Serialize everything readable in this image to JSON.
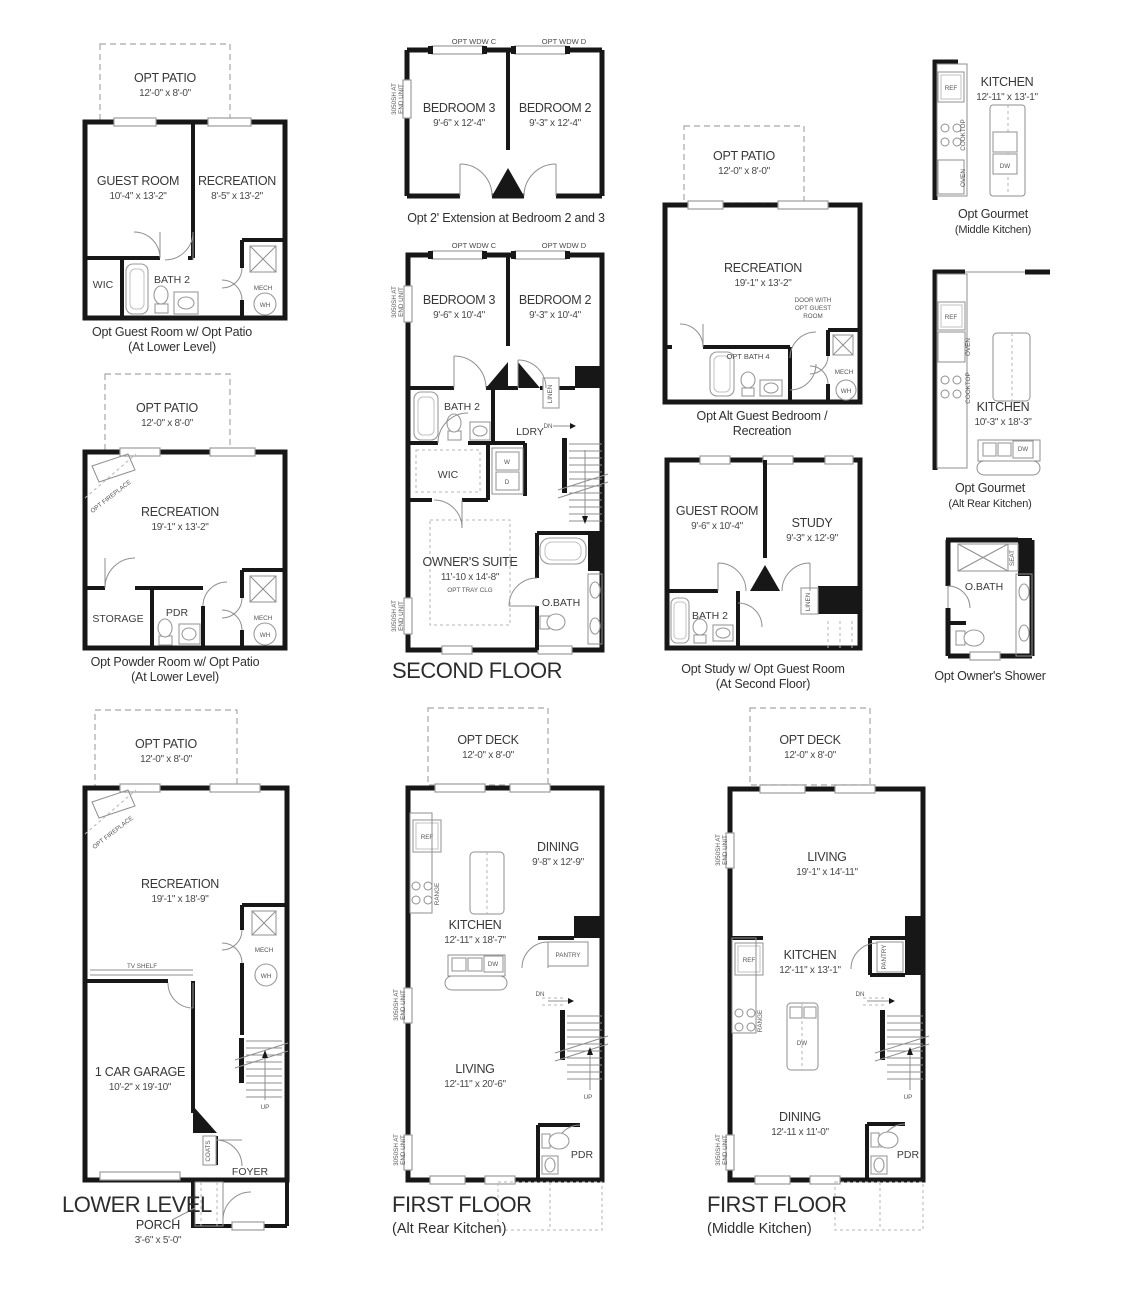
{
  "p1": {
    "patio": "OPT PATIO",
    "patio_dims": "12'-0\" x 8'-0\"",
    "guest": "GUEST ROOM",
    "guest_dims": "10'-4\" x 13'-2\"",
    "rec": "RECREATION",
    "rec_dims": "8'-5\" x 13'-2\"",
    "wic": "WIC",
    "bath": "BATH 2",
    "mech": "MECH",
    "wh": "WH",
    "cap1": "Opt Guest Room w/ Opt Patio",
    "cap2": "(At Lower Level)"
  },
  "p2": {
    "patio": "OPT PATIO",
    "patio_dims": "12'-0\" x 8'-0\"",
    "fireplace": "OPT FIREPLACE",
    "rec": "RECREATION",
    "rec_dims": "19'-1\" x 13'-2\"",
    "storage": "STORAGE",
    "pdr": "PDR",
    "mech": "MECH",
    "wh": "WH",
    "cap1": "Opt Powder Room w/ Opt Patio",
    "cap2": "(At Lower Level)"
  },
  "p3": {
    "patio": "OPT PATIO",
    "patio_dims": "12'-0\" x 8'-0\"",
    "fireplace": "OPT FIREPLACE",
    "rec": "RECREATION",
    "rec_dims": "19'-1\" x 18'-9\"",
    "mech": "MECH",
    "wh": "WH",
    "tv": "TV SHELF",
    "garage": "1 CAR GARAGE",
    "garage_dims": "10'-2\" x 19'-10\"",
    "coats": "COATS",
    "foyer": "FOYER",
    "up": "UP",
    "title": "LOWER LEVEL",
    "porch": "PORCH",
    "porch_dims": "3'-6\" x 5'-0\""
  },
  "p4": {
    "wdw_c": "OPT WDW C",
    "wdw_d": "OPT WDW D",
    "sh1": "3050SH AT",
    "sh2": "END UNIT",
    "b3": "BEDROOM 3",
    "b3_dims": "9'-6\" x 12'-4\"",
    "b2": "BEDROOM 2",
    "b2_dims": "9'-3\" x 12'-4\"",
    "cap": "Opt 2' Extension at Bedroom 2 and 3"
  },
  "p5": {
    "wdw_c": "OPT WDW C",
    "wdw_d": "OPT WDW D",
    "sh1": "3050SH AT",
    "sh2": "END UNIT",
    "b3": "BEDROOM 3",
    "b3_dims": "9'-6\" x 10'-4\"",
    "b2": "BEDROOM 2",
    "b2_dims": "9'-3\" x 10'-4\"",
    "bath": "BATH 2",
    "linen": "LINEN",
    "ldry": "LDRY",
    "dn": "DN",
    "w": "W",
    "d": "D",
    "wic": "WIC",
    "owners": "OWNER'S SUITE",
    "owners_dims": "11'-10 x 14'-8\"",
    "owners_note": "OPT TRAY CLG",
    "obath": "O.BATH",
    "title": "SECOND FLOOR"
  },
  "p6": {
    "patio": "OPT PATIO",
    "patio_dims": "12'-0\" x 8'-0\"",
    "rec": "RECREATION",
    "rec_dims": "19'-1\" x 13'-2\"",
    "door1": "DOOR WITH",
    "door2": "OPT GUEST",
    "door3": "ROOM",
    "bath4": "OPT BATH 4",
    "mech": "MECH",
    "wh": "WH",
    "cap1": "Opt Alt Guest Bedroom /",
    "cap2": "Recreation"
  },
  "p7": {
    "guest": "GUEST ROOM",
    "guest_dims": "9'-6\" x 10'-4\"",
    "study": "STUDY",
    "study_dims": "9'-3\" x 12'-9\"",
    "bath": "BATH 2",
    "linen": "LINEN",
    "cap1": "Opt Study w/ Opt Guest Room",
    "cap2": "(At Second Floor)"
  },
  "p8": {
    "ref": "REF",
    "kitchen": "KITCHEN",
    "kitchen_dims": "12'-11\" x 13'-1\"",
    "cooktop": "COOKTOP",
    "oven": "OVEN",
    "dw": "DW",
    "cap1": "Opt Gourmet",
    "cap2": "(Middle Kitchen)"
  },
  "p9": {
    "ref": "REF",
    "oven": "OVEN",
    "cooktop": "COOKTOP",
    "kitchen": "KITCHEN",
    "kitchen_dims": "10'-3\" x 18'-3\"",
    "dw": "DW",
    "cap1": "Opt Gourmet",
    "cap2": "(Alt Rear Kitchen)"
  },
  "p10": {
    "seat": "SEAT",
    "obath": "O.BATH",
    "cap": "Opt Owner's Shower"
  },
  "p11": {
    "deck": "OPT DECK",
    "deck_dims": "12'-0\" x 8'-0\"",
    "ref": "REF",
    "range": "RANGE",
    "dining": "DINING",
    "dining_dims": "9'-8\" x 12'-9\"",
    "kitchen": "KITCHEN",
    "kitchen_dims": "12'-11\" x 18'-7\"",
    "dw": "DW",
    "pantry": "PANTRY",
    "dn": "DN",
    "living": "LIVING",
    "living_dims": "12'-11\" x 20'-6\"",
    "up": "UP",
    "pdr": "PDR",
    "sh1": "3050SH AT",
    "sh2": "END UNIT",
    "title": "FIRST FLOOR",
    "subtitle": "(Alt Rear Kitchen)"
  },
  "p12": {
    "deck": "OPT DECK",
    "deck_dims": "12'-0\" x 8'-0\"",
    "sh1": "3050SH AT",
    "sh2": "END UNIT",
    "living": "LIVING",
    "living_dims": "19'-1\" x 14'-11\"",
    "kitchen": "KITCHEN",
    "kitchen_dims": "12'-11\" x 13'-1\"",
    "ref": "REF",
    "pantry": "PANTRY",
    "range": "RANGE",
    "dw": "DW",
    "dn": "DN",
    "up": "UP",
    "dining": "DINING",
    "dining_dims": "12'-11 x 11'-0\"",
    "pdr": "PDR",
    "title": "FIRST FLOOR",
    "subtitle": "(Middle Kitchen)"
  }
}
